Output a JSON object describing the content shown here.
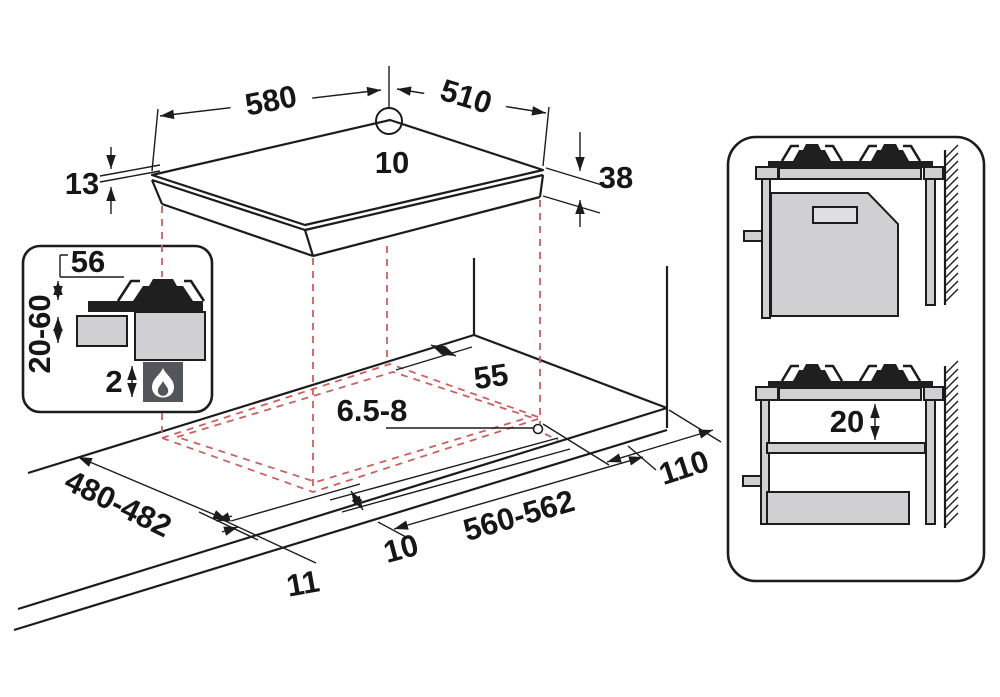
{
  "diagram_title": "Built-in gas hob installation dimensions diagram",
  "colors": {
    "line": "#1c1c1c",
    "projection_red": "#cc5f5f",
    "fill_light_gray": "#d0d0d2",
    "fill_dark_gray": "#54555a",
    "background": "#ffffff"
  },
  "hob_top_view": {
    "width": "580",
    "depth": "510",
    "rear_offset": "10",
    "glass_thickness": "13",
    "body_height": "38"
  },
  "burner_detail_inset": {
    "burner_height": "56",
    "clearance_range": "20-60",
    "bottom_gap": "2"
  },
  "worktop_view": {
    "rear_clearance": "55",
    "hole_diameter": "6.5-8",
    "side_clearance": "110",
    "cutout_depth": "480-482",
    "cutout_width": "560-562",
    "front_offset": "10",
    "side_offset": "11"
  },
  "side_views": {
    "shelf_clearance": "20"
  }
}
